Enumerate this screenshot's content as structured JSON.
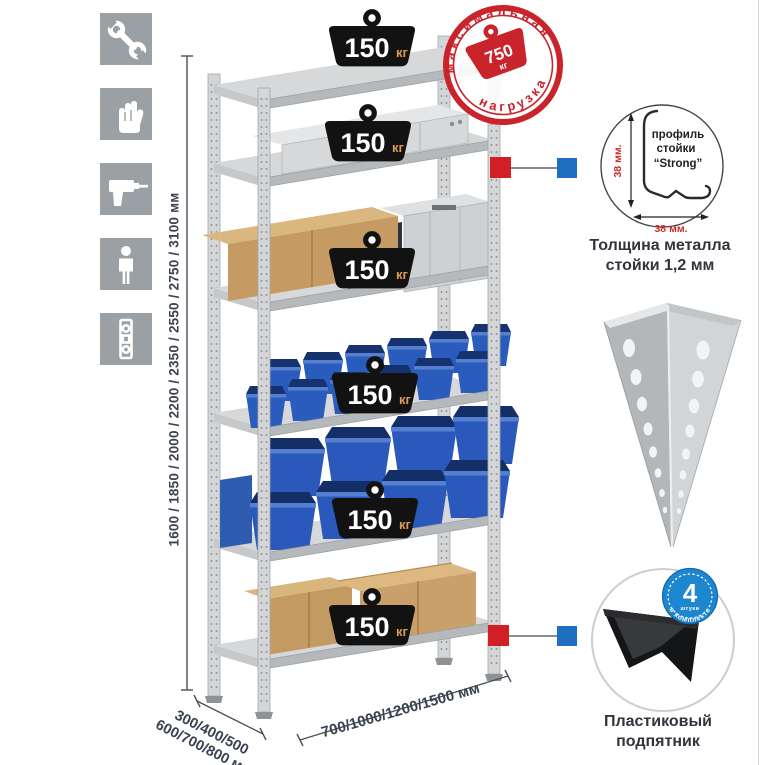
{
  "icons": [
    {
      "name": "wrench"
    },
    {
      "name": "gloves"
    },
    {
      "name": "drill"
    },
    {
      "name": "person"
    },
    {
      "name": "level"
    }
  ],
  "dimensions": {
    "height": "1600 / 1850 / 2000 / 2200 / 2350 / 2550 / 2750 / 3100 мм",
    "depth_line1": "300/400/500",
    "depth_line2": "600/700/800 мм",
    "width": "700/1000/1200/1500 мм"
  },
  "weights": [
    {
      "value": "150",
      "unit": "кг"
    },
    {
      "value": "150",
      "unit": "кг"
    },
    {
      "value": "150",
      "unit": "кг"
    },
    {
      "value": "150",
      "unit": "кг"
    },
    {
      "value": "150",
      "unit": "кг"
    },
    {
      "value": "150",
      "unit": "кг"
    }
  ],
  "stamp": {
    "arc_top": "максимальная",
    "arc_bottom": "нагрузка",
    "value": "750",
    "unit": "кг"
  },
  "profile": {
    "label_line1": "профиль",
    "label_line2": "стойки",
    "label_line3": "“Strong”",
    "dim_vertical": "38 мм.",
    "dim_horizontal": "38 мм.",
    "caption_line1": "Толщина металла",
    "caption_line2": "стойки 1,2 мм"
  },
  "foot": {
    "badge_value": "4",
    "badge_sub": "штуки",
    "badge_arc": "в комплекте",
    "caption_line1": "Пластиковый",
    "caption_line2": "подпятник"
  },
  "colors": {
    "stamp_red": "#c9242b",
    "marker_red": "#d21f26",
    "marker_blue": "#1e6fc0",
    "badge_blue": "#1e86cf",
    "bin_blue": "#2a59bb",
    "dim_red": "#d12b23",
    "text_dark": "#3a4150"
  }
}
